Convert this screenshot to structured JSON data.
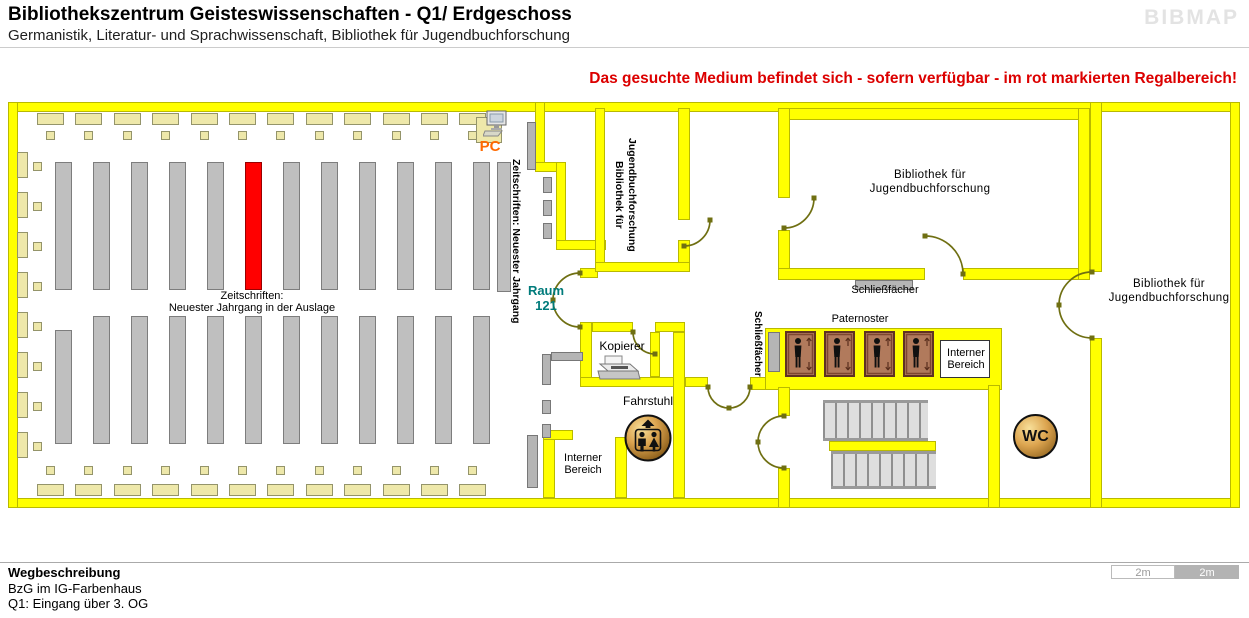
{
  "header": {
    "title": "Bibliothekszentrum Geisteswissenschaften - Q1/ Erdgeschoss",
    "subtitle": "Germanistik, Literatur- und Sprachwissenschaft, Bibliothek für Jugendbuchforschung",
    "logo": "BIBMAP"
  },
  "notice": "Das gesuchte Medium befindet sich - sofern verfügbar - im rot markierten Regalbereich!",
  "plan": {
    "reading_room": {
      "shelf_label_line1": "Zeitschriften:",
      "shelf_label_line2": "Neuester Jahrgang in der Auslage",
      "journals_vertical": "Zeitschriften: Neuester Jahrgang",
      "pc_label": "PC"
    },
    "rooms": {
      "raum_line1": "Raum",
      "raum_line2": "121",
      "jugendbuch": {
        "line1": "Bibliothek für",
        "line2": "Jugendbuchforschung"
      },
      "kopierer": "Kopierer",
      "fahrstuhl": "Fahrstuhl",
      "interner": {
        "line1": "Interner",
        "line2": "Bereich"
      },
      "paternoster": "Paternoster",
      "schliessfaecher": "Schließfächer",
      "wc": "WC"
    }
  },
  "footer": {
    "heading": "Wegbeschreibung",
    "line1": "BzG im IG-Farbenhaus",
    "line2": "Q1: Eingang über 3. OG"
  },
  "scalebar": {
    "left": "2m",
    "right": "2m"
  },
  "colors": {
    "wall": "#ffff00",
    "wall_edge": "#b9b900",
    "shelf": "#bfbfbf",
    "shelf_edge": "#7d7d7d",
    "table": "#eee8aa",
    "table_edge": "#94946a",
    "highlight": "#ff0000",
    "door": "#6f6f12",
    "notice": "#dc0000",
    "raum": "#007b7b",
    "pc": "#ff6a00",
    "logo": "#e3e3e3",
    "cabin": "#b17a5c",
    "cabin_edge": "#5f3222",
    "gold_light": "#f8e09a",
    "gold_dark": "#7d5312"
  }
}
